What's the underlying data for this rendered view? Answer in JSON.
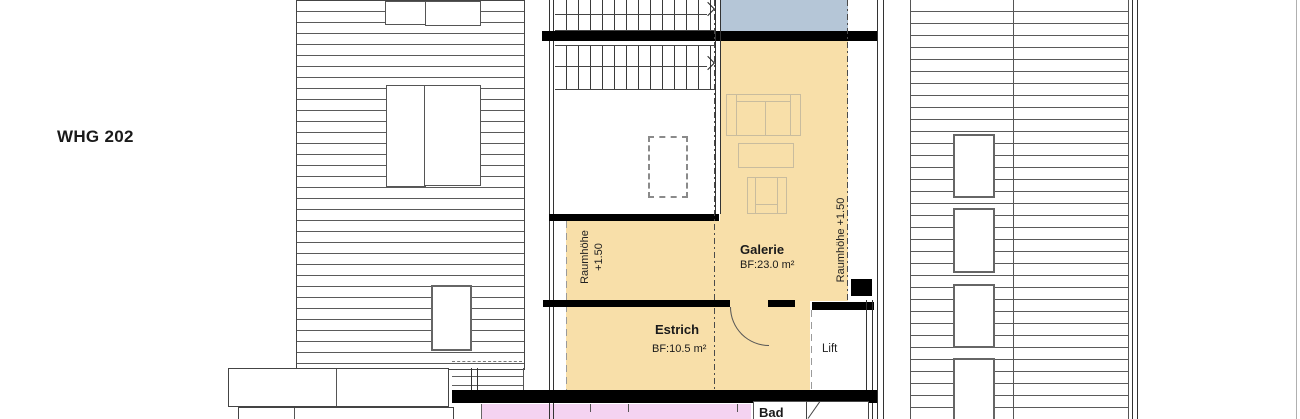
{
  "title": {
    "apartment": "WHG 202"
  },
  "rooms": {
    "galerie": {
      "name": "Galerie",
      "area": "BF:23.0 m²"
    },
    "estrich": {
      "name": "Estrich",
      "area": "BF:10.5 m²"
    },
    "lift": {
      "name": "Lift"
    },
    "bad": {
      "name": "Bad"
    }
  },
  "annotations": {
    "room_height_left": {
      "line1": "Raumhöhe",
      "line2": "+1.50"
    },
    "room_height_right": "Raumhöhe +1.50"
  },
  "colors": {
    "floor_beige": "#f8dfa9",
    "roof_panel_blue": "#b5c6d7",
    "bath_pink": "#f4d3f1",
    "wall_black": "#000000",
    "hatch_line": "#555555",
    "furniture_line": "#c9bc9e"
  }
}
